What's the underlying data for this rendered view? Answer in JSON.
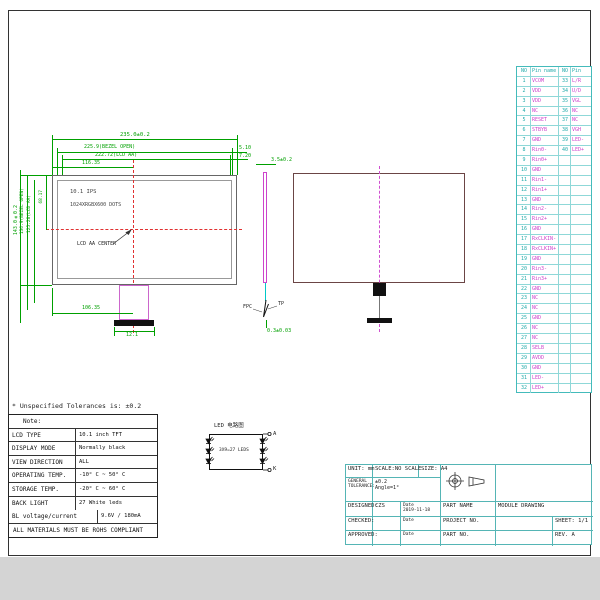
{
  "colors": {
    "dimension": "#00a000",
    "centerline_red": "#e03030",
    "centerline_magenta": "#d050d0",
    "pin_grid": "#44bbbb",
    "pin_name": "#cc44cc",
    "pin_number": "#22aaaa",
    "title_block_grid": "#55b5b5",
    "side_view_outline": "#cc44cc"
  },
  "front_view": {
    "panel_label": "10.1 IPS",
    "resolution_label": "1024XRGBX600 DOTS",
    "aa_center_label": "LCD AA CENTER",
    "dim_width_outline": "235.0±0.2",
    "dim_width_bezel": "225.9(BEZEL OPEN)",
    "dim_width_aa": "222.72(LCD AA)",
    "dim_center_x": "116.35",
    "dim_right_1": "5.10",
    "dim_right_2": "7.20",
    "dim_height_outline": "143.0±0.2",
    "dim_height_bezel": "136.9(BEZEL OPEN)",
    "dim_height_aa": "125.28(LCD AA)",
    "dim_center_y": "68.17",
    "dim_bottom_1": "106.35",
    "dim_bottom_2": "12.1"
  },
  "side_view": {
    "dim_thickness": "3.5±0.2",
    "dim_fpc_thickness": "0.3±0.03",
    "label_fpc": "FPC",
    "label_tp": "TP"
  },
  "tolerance_note": "* Unspecified Tolerances is: ±0.2",
  "notes": {
    "title": "Note:",
    "rows": [
      [
        "LCD TYPE",
        "10.1 inch TFT Transmissive"
      ],
      [
        "DISPLAY MODE",
        "Normally black"
      ],
      [
        "VIEW DIRECTION",
        "ALL"
      ],
      [
        "OPERATING TEMP.",
        "-10° C ~ 50° C"
      ],
      [
        "STORAGE TEMP.",
        "-20° C ~ 60° C"
      ],
      [
        "BACK LIGHT",
        "27 White leds"
      ]
    ],
    "bl_row": [
      "BL voltage/current",
      "9.6V / 180mA"
    ],
    "footer": "ALL MATERIALS MUST BE ROHS COMPLIANT"
  },
  "led_diagram": {
    "title": "LED 电路图",
    "center_label": "3X9=27 LEDS",
    "terminal_a": "A",
    "terminal_k": "K"
  },
  "pin_table": {
    "headers": [
      "NO",
      "Pin name",
      "NO",
      "Pin name"
    ],
    "left_pins": [
      [
        "1",
        "VCOM"
      ],
      [
        "2",
        "VDD"
      ],
      [
        "3",
        "VDD"
      ],
      [
        "4",
        "NC"
      ],
      [
        "5",
        "RESET"
      ],
      [
        "6",
        "STBYB"
      ],
      [
        "7",
        "GND"
      ],
      [
        "8",
        "Rin0-"
      ],
      [
        "9",
        "Rin0+"
      ],
      [
        "10",
        "GND"
      ],
      [
        "11",
        "Rin1-"
      ],
      [
        "12",
        "Rin1+"
      ],
      [
        "13",
        "GND"
      ],
      [
        "14",
        "Rin2-"
      ],
      [
        "15",
        "Rin2+"
      ],
      [
        "16",
        "GND"
      ],
      [
        "17",
        "RxCLKIN-"
      ],
      [
        "18",
        "RxCLKIN+"
      ],
      [
        "19",
        "GND"
      ],
      [
        "20",
        "Rin3-"
      ],
      [
        "21",
        "Rin3+"
      ],
      [
        "22",
        "GND"
      ],
      [
        "23",
        "NC"
      ],
      [
        "24",
        "NC"
      ],
      [
        "25",
        "GND"
      ],
      [
        "26",
        "NC"
      ],
      [
        "27",
        "NC"
      ],
      [
        "28",
        "SELB"
      ],
      [
        "29",
        "AVDD"
      ],
      [
        "30",
        "GND"
      ],
      [
        "31",
        "LED-"
      ],
      [
        "32",
        "LED+"
      ]
    ],
    "right_pins": [
      [
        "33",
        "L/R"
      ],
      [
        "34",
        "U/D"
      ],
      [
        "35",
        "VGL"
      ],
      [
        "36",
        "NC"
      ],
      [
        "37",
        "NC"
      ],
      [
        "38",
        "VGH"
      ],
      [
        "39",
        "LED-"
      ],
      [
        "40",
        "LED+"
      ]
    ]
  },
  "title_block": {
    "unit": "UNIT: mm",
    "scale": "SCALE:NO SCALE",
    "size": "SIZE: A4",
    "general_tolerance_label_1": "GENERAL",
    "general_tolerance_label_2": "TOLERANCE:",
    "tolerance_value": "±0.2",
    "angle_value": "Angle=1°",
    "designed_label": "DESIGNED:",
    "designed_value": "CZS",
    "date_label": "Date",
    "date_value": "2019-11-18",
    "part_name_label": "PART NAME",
    "part_name_value": "MODULE DRAWING",
    "checked_label": "CHECKED:",
    "project_no_label": "PROJECT NO.",
    "sheet": "SHEET: 1/1",
    "approved_label": "APPROVED:",
    "part_no_label": "PART NO.",
    "rev": "REV. A"
  }
}
